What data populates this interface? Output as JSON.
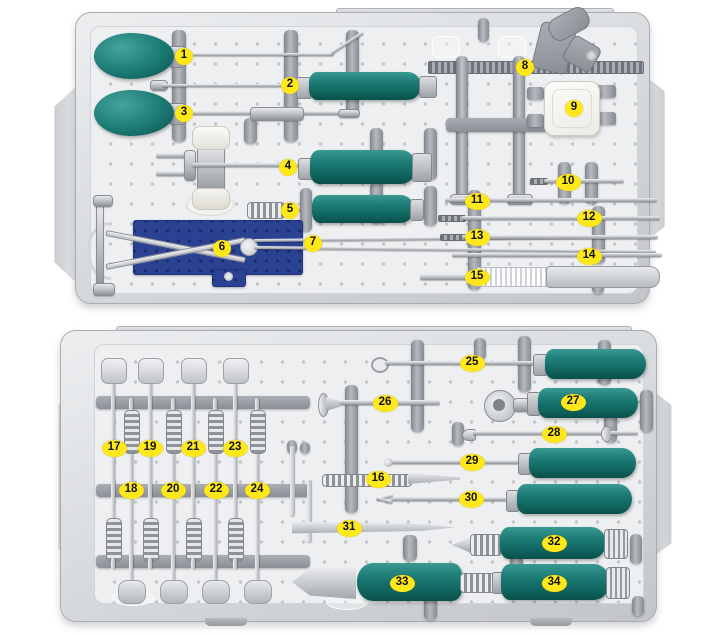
{
  "figure": {
    "type": "annotated-photograph",
    "subject": "two aluminum sterilization trays containing spinal surgery instruments with teal handles",
    "trays": [
      {
        "id": "top-tray",
        "marker_numbers": [
          "1",
          "2",
          "3",
          "4",
          "5",
          "6",
          "7",
          "8",
          "9",
          "10",
          "11",
          "12",
          "13",
          "14",
          "15"
        ]
      },
      {
        "id": "bottom-tray",
        "marker_numbers": [
          "16",
          "17",
          "18",
          "19",
          "20",
          "21",
          "22",
          "23",
          "24",
          "25",
          "26",
          "27",
          "28",
          "29",
          "30",
          "31",
          "32",
          "33",
          "34"
        ]
      }
    ],
    "markers": [
      {
        "n": "1",
        "x": 184,
        "y": 56
      },
      {
        "n": "2",
        "x": 290,
        "y": 85
      },
      {
        "n": "3",
        "x": 184,
        "y": 113
      },
      {
        "n": "4",
        "x": 288,
        "y": 167
      },
      {
        "n": "5",
        "x": 290,
        "y": 210
      },
      {
        "n": "6",
        "x": 222,
        "y": 248
      },
      {
        "n": "7",
        "x": 313,
        "y": 243
      },
      {
        "n": "8",
        "x": 525,
        "y": 67
      },
      {
        "n": "9",
        "x": 574,
        "y": 108
      },
      {
        "n": "10",
        "x": 568,
        "y": 182
      },
      {
        "n": "11",
        "x": 477,
        "y": 201
      },
      {
        "n": "12",
        "x": 589,
        "y": 218
      },
      {
        "n": "13",
        "x": 477,
        "y": 237
      },
      {
        "n": "14",
        "x": 589,
        "y": 256
      },
      {
        "n": "15",
        "x": 477,
        "y": 277
      },
      {
        "n": "16",
        "x": 378,
        "y": 479
      },
      {
        "n": "17",
        "x": 114,
        "y": 448
      },
      {
        "n": "18",
        "x": 131,
        "y": 490
      },
      {
        "n": "19",
        "x": 150,
        "y": 448
      },
      {
        "n": "20",
        "x": 173,
        "y": 490
      },
      {
        "n": "21",
        "x": 193,
        "y": 448
      },
      {
        "n": "22",
        "x": 216,
        "y": 490
      },
      {
        "n": "23",
        "x": 235,
        "y": 448
      },
      {
        "n": "24",
        "x": 257,
        "y": 490
      },
      {
        "n": "25",
        "x": 472,
        "y": 363
      },
      {
        "n": "26",
        "x": 385,
        "y": 403
      },
      {
        "n": "27",
        "x": 573,
        "y": 402
      },
      {
        "n": "28",
        "x": 554,
        "y": 434
      },
      {
        "n": "29",
        "x": 472,
        "y": 462
      },
      {
        "n": "30",
        "x": 471,
        "y": 499
      },
      {
        "n": "31",
        "x": 349,
        "y": 528
      },
      {
        "n": "32",
        "x": 554,
        "y": 543
      },
      {
        "n": "33",
        "x": 402,
        "y": 583
      },
      {
        "n": "34",
        "x": 554,
        "y": 583
      }
    ],
    "colors": {
      "handle_teal": "#1b7a74",
      "handle_teal_highlight": "#3a9a92",
      "handle_teal_dark": "#0a4f4a",
      "marker_yellow": "#ffe81a",
      "marker_text": "#101010",
      "tray_metal": "#d6d9dc",
      "plate_gray": "#edeff1",
      "rail_gray": "#9599a0",
      "blue_template_plate": "#2b4191",
      "instrument_metal": "#b9bcc1",
      "white_block": "#f8f8f5"
    }
  }
}
